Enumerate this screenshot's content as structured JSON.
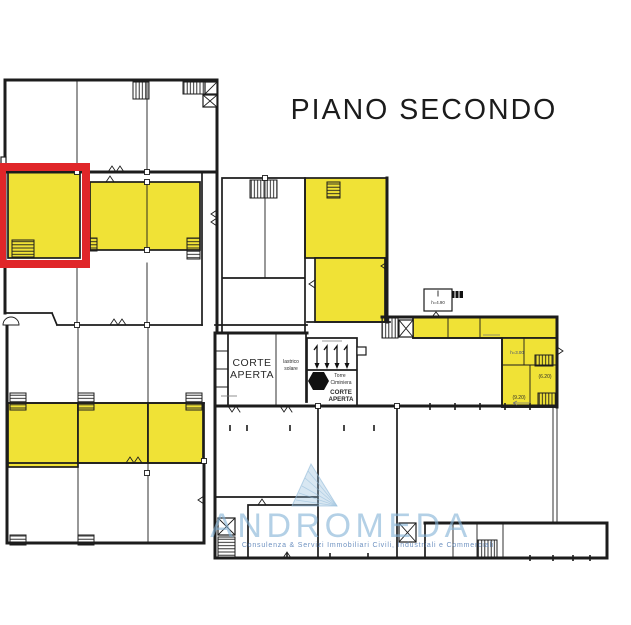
{
  "title": "PIANO SECONDO",
  "colors": {
    "background": "#FFFFFF",
    "highlight": "#F0E236",
    "selection": "#E02629",
    "wall": "#1C1C1C",
    "watermark": "#8FB9D9",
    "watermark_text": "#85B3D6",
    "watermark_tagline": "#4976B0"
  },
  "plan": {
    "labels": {
      "corte_aperta": [
        "CORTE",
        "APERTA"
      ],
      "lastrico_solare": [
        "lastrico",
        "solare"
      ],
      "torre_ciminiera": [
        "Torre",
        "Ciminiera"
      ],
      "corte_aperta_small": [
        "CORTE",
        "APERTA"
      ],
      "height_490": "h=4.90",
      "height_300": "h=3.00",
      "quota_620": "(6.20)",
      "quota_920": "(9.20)"
    }
  },
  "watermark": {
    "name": "ANDROMEDA",
    "tagline": "Consulenza & Servizi Immobiliari Civili, Industriali e Commerciali"
  }
}
